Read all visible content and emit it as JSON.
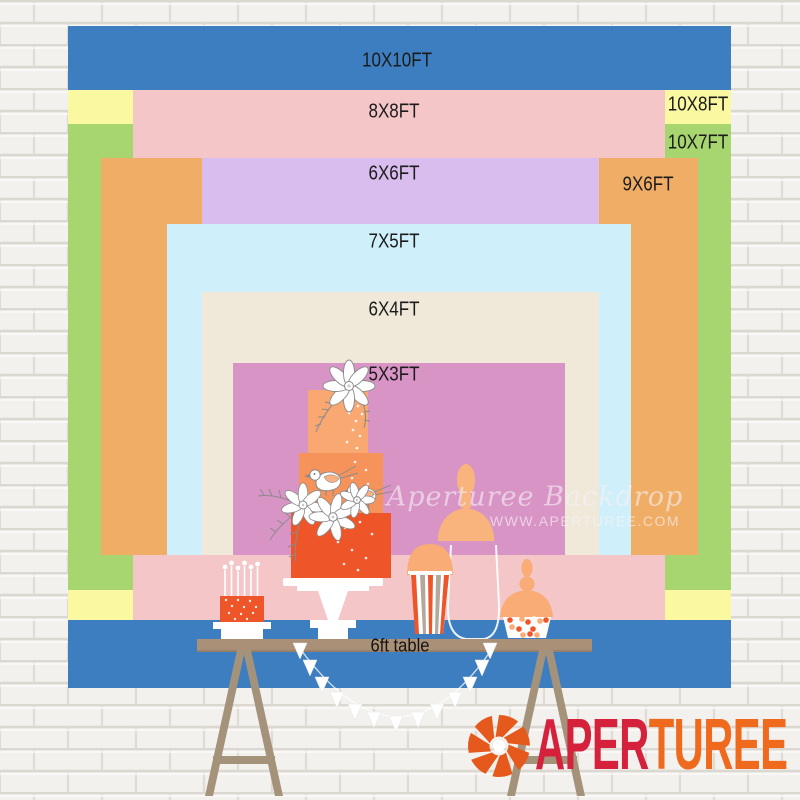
{
  "size_chart": {
    "labels": [
      {
        "text": "10X10FT",
        "color": "#3D7EC1"
      },
      {
        "text": "8X8FT",
        "color": "#F4C6C8"
      },
      {
        "text": "10X8FT",
        "color": "#FAF8A1"
      },
      {
        "text": "10X7FT",
        "color": "#A7D56F"
      },
      {
        "text": "6X6FT",
        "color": "#DABDEF"
      },
      {
        "text": "9X6FT",
        "color": "#F0AD66"
      },
      {
        "text": "7X5FT",
        "color": "#CFF0FA"
      },
      {
        "text": "6X4FT",
        "color": "#F0E9D9"
      },
      {
        "text": "5X3FT",
        "color": "#D994C6"
      }
    ],
    "label_text_color": "#1b1b1b"
  },
  "table": {
    "label": "6ft table",
    "color": "#A99077"
  },
  "watermark": {
    "line1": "Aperturee Backdrop",
    "line2": "WWW.APERTUREE.COM"
  },
  "logo": {
    "part1": "APER",
    "part2": "TUREE",
    "part1_color": "#D6213C",
    "part2_color": "#F06A1E",
    "icon": "aperture-icon",
    "icon_color": "#E6591D"
  },
  "illustration_colors": {
    "cake_top_tier": "#F9A872",
    "cake_middle_tier": "#F6935A",
    "cake_bottom_tier": "#EE5528",
    "peach_accent": "#F9AC76",
    "table_wood": "#A99077",
    "trestle_wood": "#A5927A"
  }
}
